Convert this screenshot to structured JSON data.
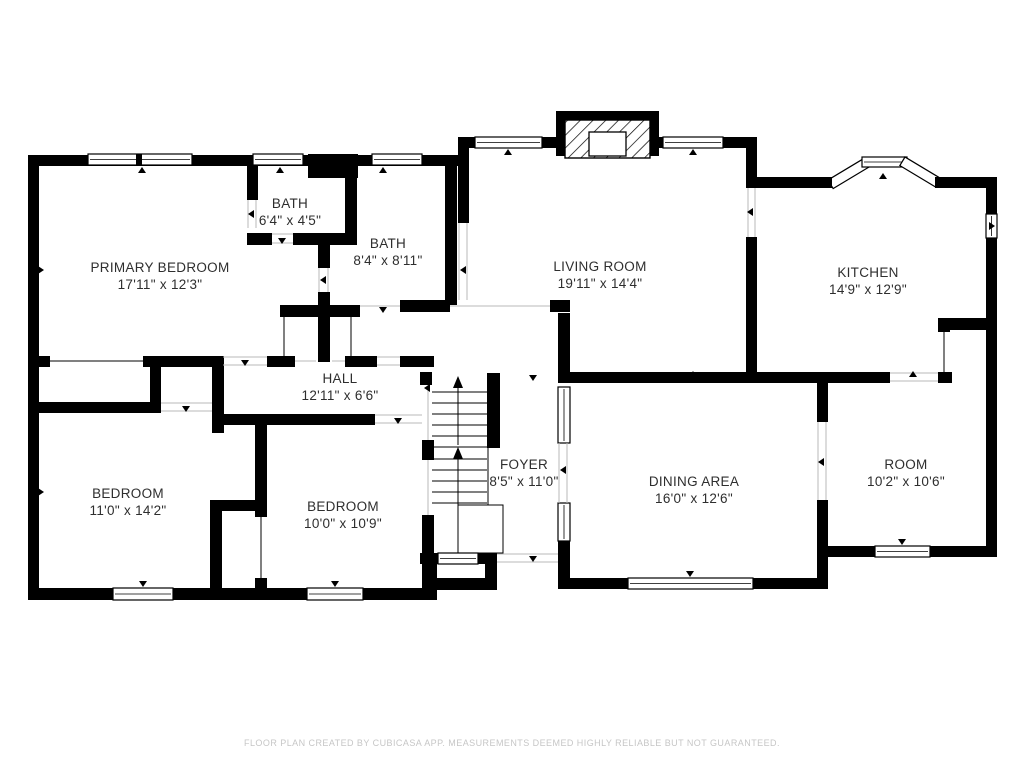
{
  "page": {
    "background": "#ffffff",
    "wall_color": "#000000",
    "label_color": "#2e2e2e",
    "footer_color": "#c6c6c6"
  },
  "rooms": [
    {
      "name": "PRIMARY BEDROOM",
      "dims": "17'11\" x 12'3\""
    },
    {
      "name": "BATH",
      "dims": "6'4\" x 4'5\""
    },
    {
      "name": "BATH",
      "dims": "8'4\" x 8'11\""
    },
    {
      "name": "LIVING ROOM",
      "dims": "19'11\" x 14'4\""
    },
    {
      "name": "KITCHEN",
      "dims": "14'9\" x 12'9\""
    },
    {
      "name": "HALL",
      "dims": "12'11\" x 6'6\""
    },
    {
      "name": "BEDROOM",
      "dims": "11'0\" x 14'2\""
    },
    {
      "name": "BEDROOM",
      "dims": "10'0\" x 10'9\""
    },
    {
      "name": "FOYER",
      "dims": "8'5\" x 11'0\""
    },
    {
      "name": "DINING AREA",
      "dims": "16'0\" x 12'6\""
    },
    {
      "name": "ROOM",
      "dims": "10'2\" x 10'6\""
    }
  ],
  "footer": {
    "text": "FLOOR PLAN CREATED BY CUBICASA APP. MEASUREMENTS DEEMED HIGHLY RELIABLE BUT NOT GUARANTEED."
  }
}
